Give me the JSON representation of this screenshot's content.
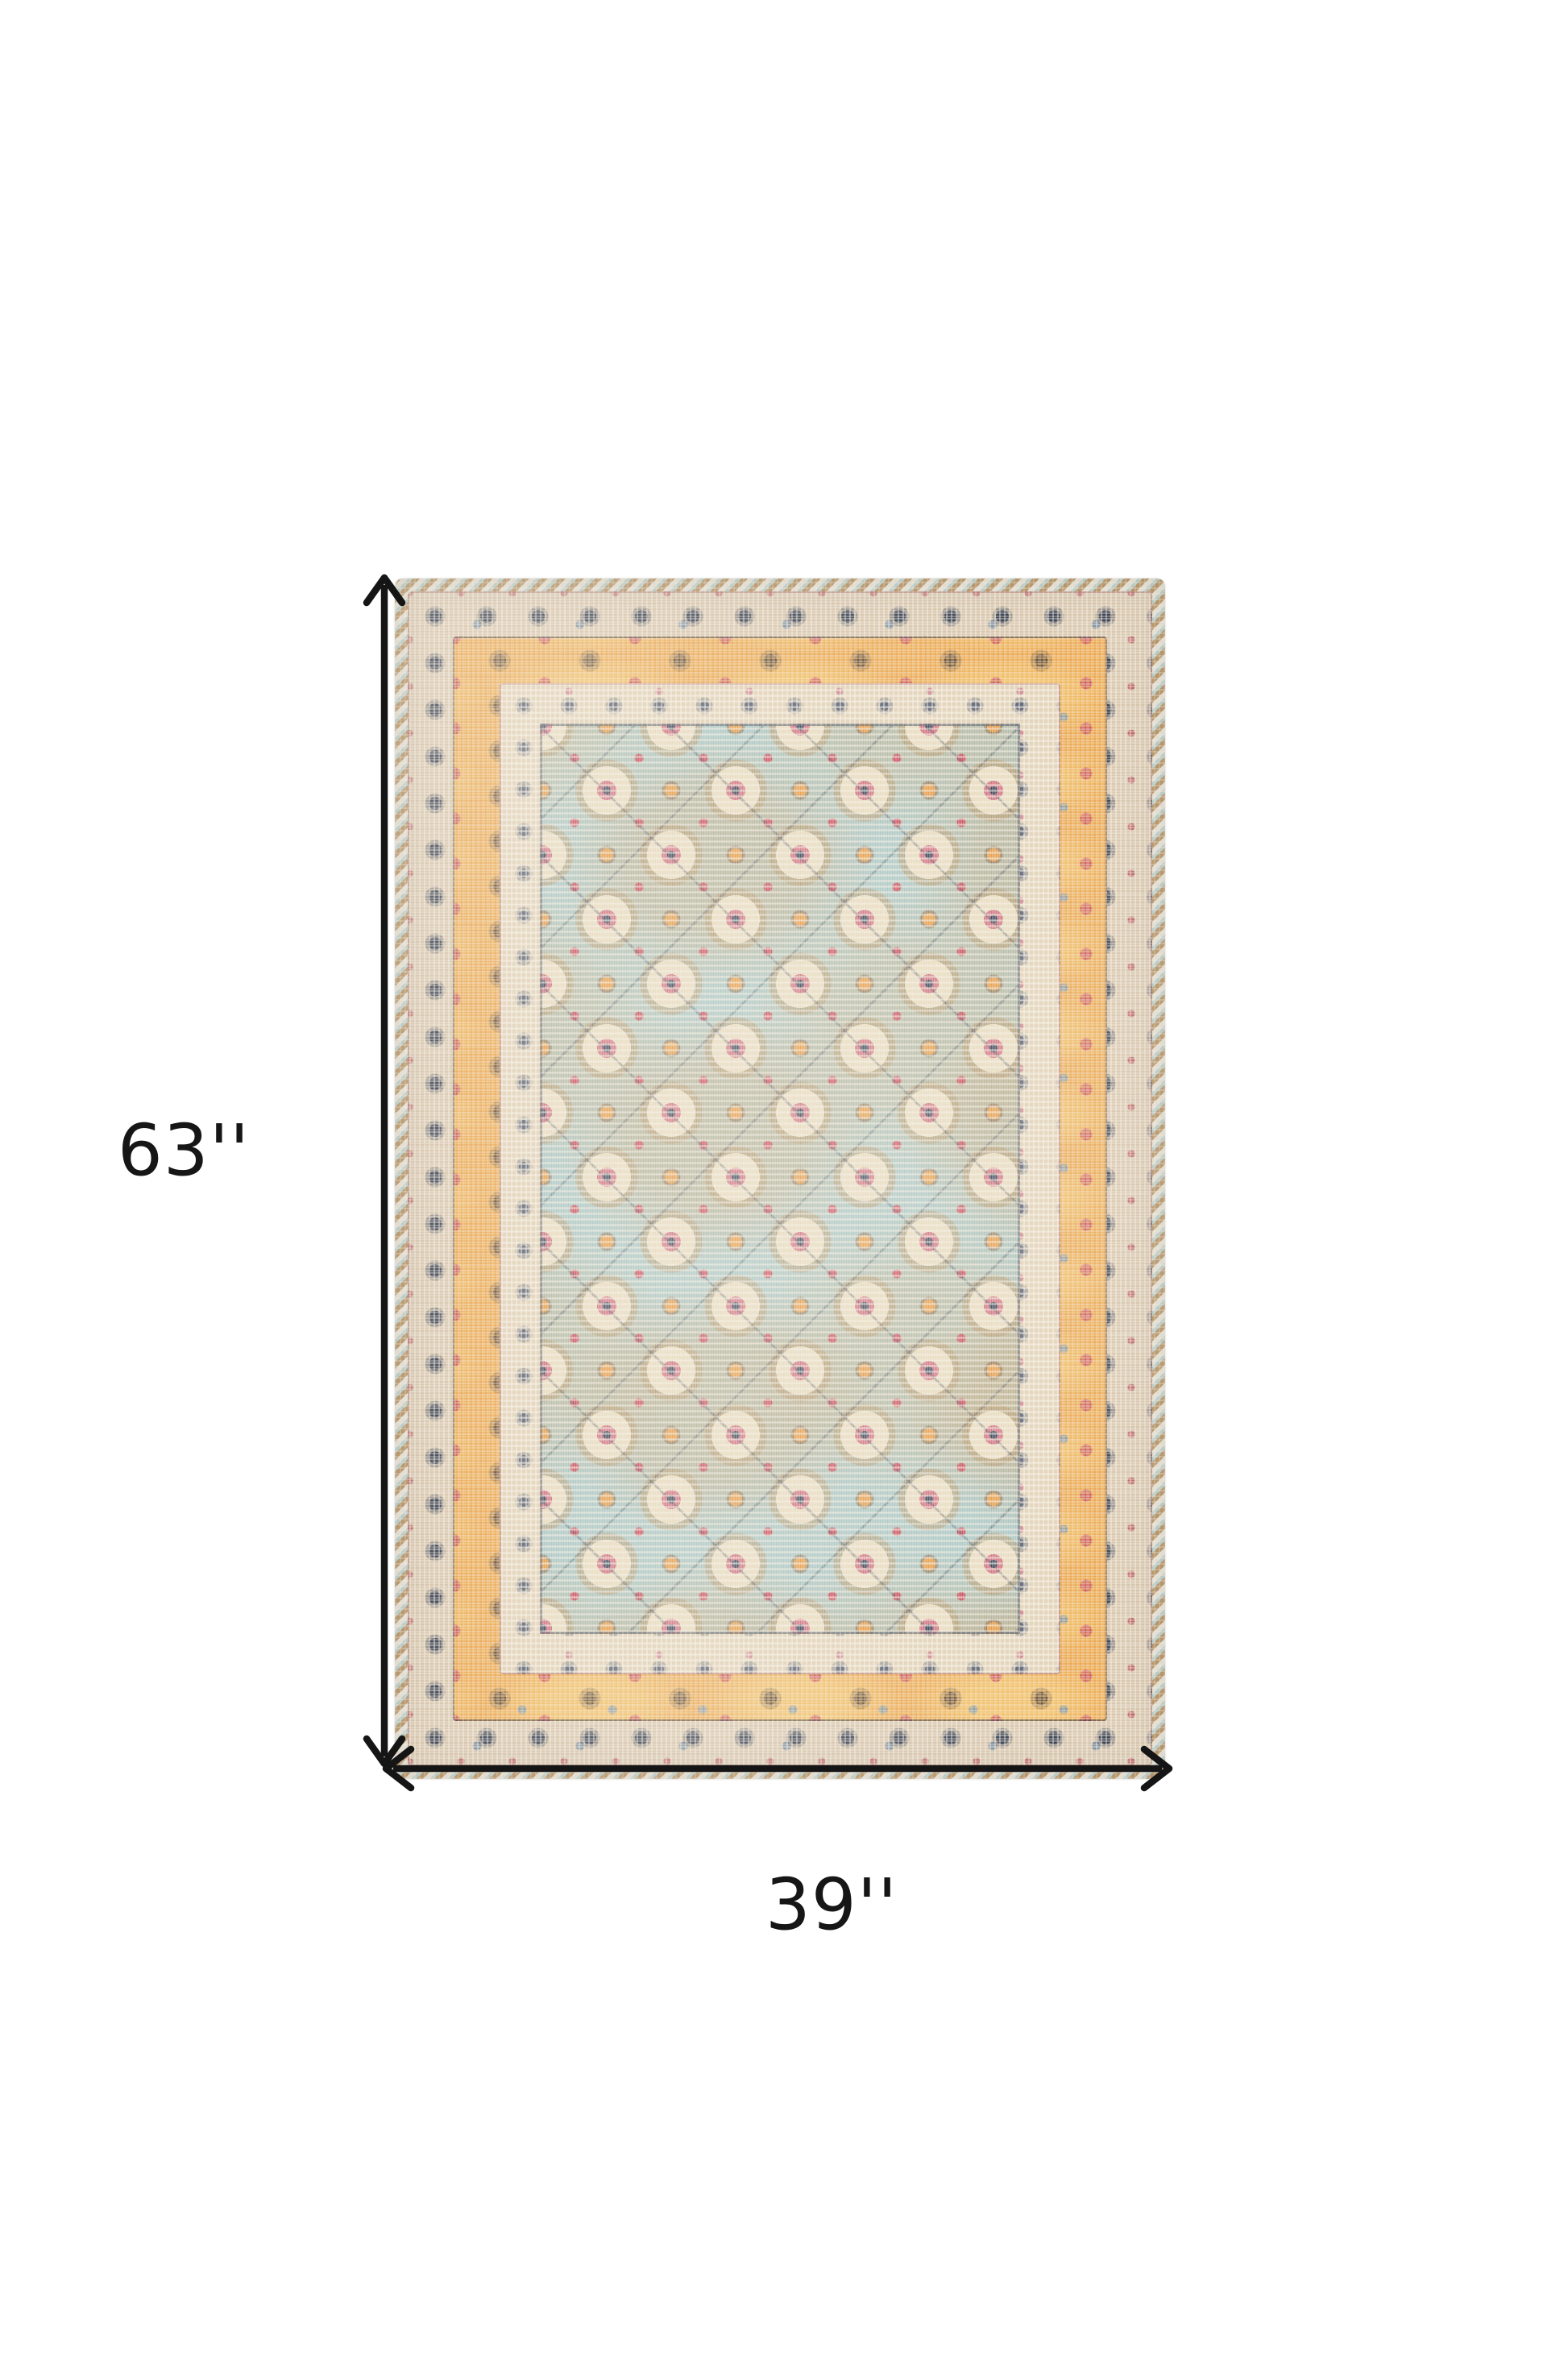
{
  "page": {
    "background": "#ffffff"
  },
  "annotations": {
    "height_label": "63''",
    "width_label": "39''",
    "arrow_color": "#151515",
    "label_color": "#161616"
  },
  "product": {
    "item": "area-rug-photo",
    "height_inches": "63",
    "width_inches": "39",
    "palette": {
      "field_blue": "#a6c6c6",
      "border_orange": "#eba44f",
      "border_cream": "#e4d5bd",
      "border_taupe": "#d8c6ae",
      "selvage_tan": "#ba9464",
      "accent_red": "#c8495a",
      "accent_pink": "#d06f80",
      "accent_navy": "#36405a",
      "accent_tan": "#bfa37c",
      "rosette_cream": "#e9dcc0"
    }
  }
}
